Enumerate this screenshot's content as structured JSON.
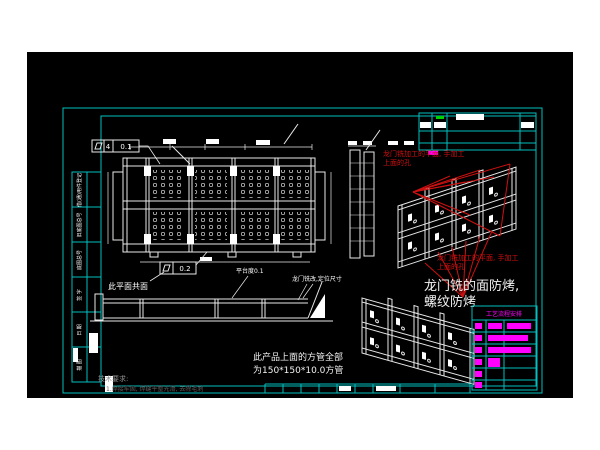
{
  "app": {
    "title": "CAD drawing viewport"
  },
  "colors": {
    "canvas_bg": "#000000",
    "border_cyan": "#00c0c0",
    "line_white": "#e9e9e9",
    "annotation_red": "#cf1010",
    "table_magenta": "#ff00ff",
    "tick_green": "#00d400",
    "dim_gray": "#8f8f8f"
  },
  "annotations": {
    "gdt_top_prefix": "4",
    "gdt_top_value": "0.1",
    "gdt_bottom_value": "0.2",
    "coplanar_label": "此平面共面",
    "platform_flatness_label": "平台度0.1",
    "gantry_mill_label": "龙门铣改,定位尺寸",
    "red_note_line1": "龙门铣加工的平面, 手加工",
    "red_note_line2": "上面的孔",
    "surface_note_line1": "龙门铣的面防烤,",
    "surface_note_line2": "螺纹防烤",
    "tube_note_line1": "此产品上面的方管全部",
    "tube_note_line2": "为150*150*10.0方管",
    "tech_title": "技术要求:",
    "tech_line": "1.焊接牢固, 焊缝平整光滑, 去除毛刺"
  },
  "process_table": {
    "header": "工艺流程安排"
  },
  "side_strip": {
    "labels": [
      "借(通)用件登记",
      "旧底图总号",
      "底图总号",
      "签 字",
      "日 期",
      "描 图"
    ]
  }
}
